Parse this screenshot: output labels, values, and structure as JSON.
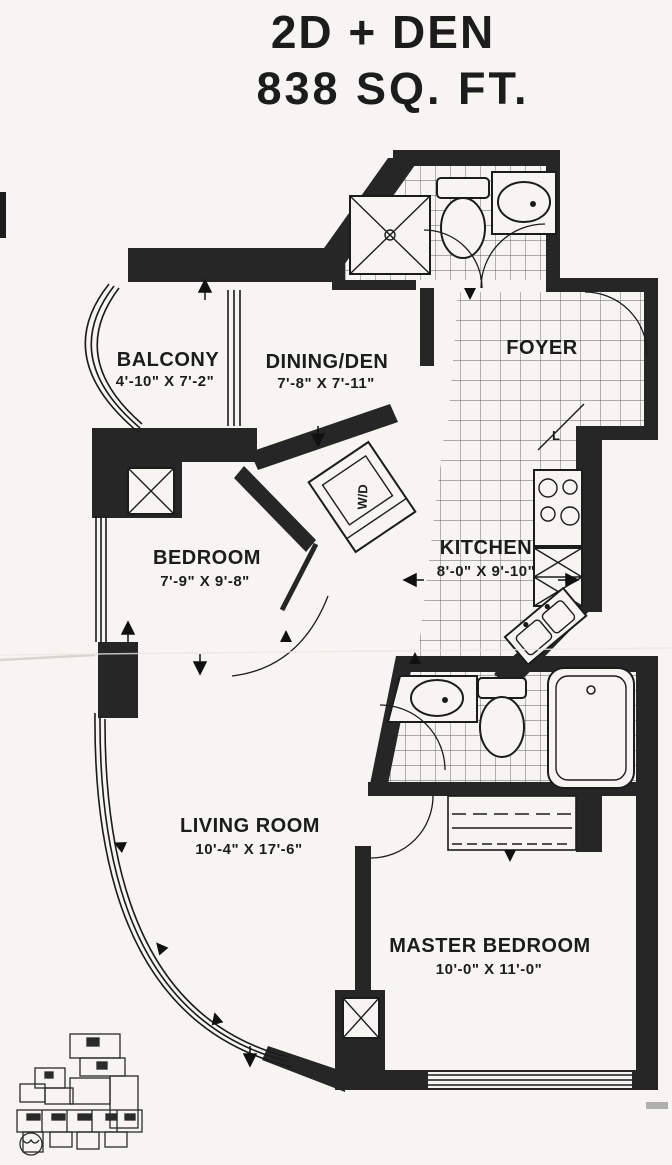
{
  "title": {
    "line1": "2D + DEN",
    "line2": "838 SQ. FT."
  },
  "rooms": {
    "balcony": {
      "name": "BALCONY",
      "dims": "4'-10\" X 7'-2\""
    },
    "dining_den": {
      "name": "DINING/DEN",
      "dims": "7'-8\" X 7'-11\""
    },
    "foyer": {
      "name": "FOYER"
    },
    "kitchen": {
      "name": "KITCHEN",
      "dims": "8'-0\" X 9'-10\""
    },
    "bedroom": {
      "name": "BEDROOM",
      "dims": "7'-9\" X 9'-8\""
    },
    "living_room": {
      "name": "LIVING ROOM",
      "dims": "10'-4\" X 17'-6\""
    },
    "master_bedroom": {
      "name": "MASTER BEDROOM",
      "dims": "10'-0\" X 11'-0\""
    }
  },
  "fixtures": {
    "washer_dryer": "W/D",
    "linen_closet": "L"
  },
  "colors": {
    "wall": "#262626",
    "paper": "#f6f5f1",
    "line": "#1c1c1c"
  }
}
